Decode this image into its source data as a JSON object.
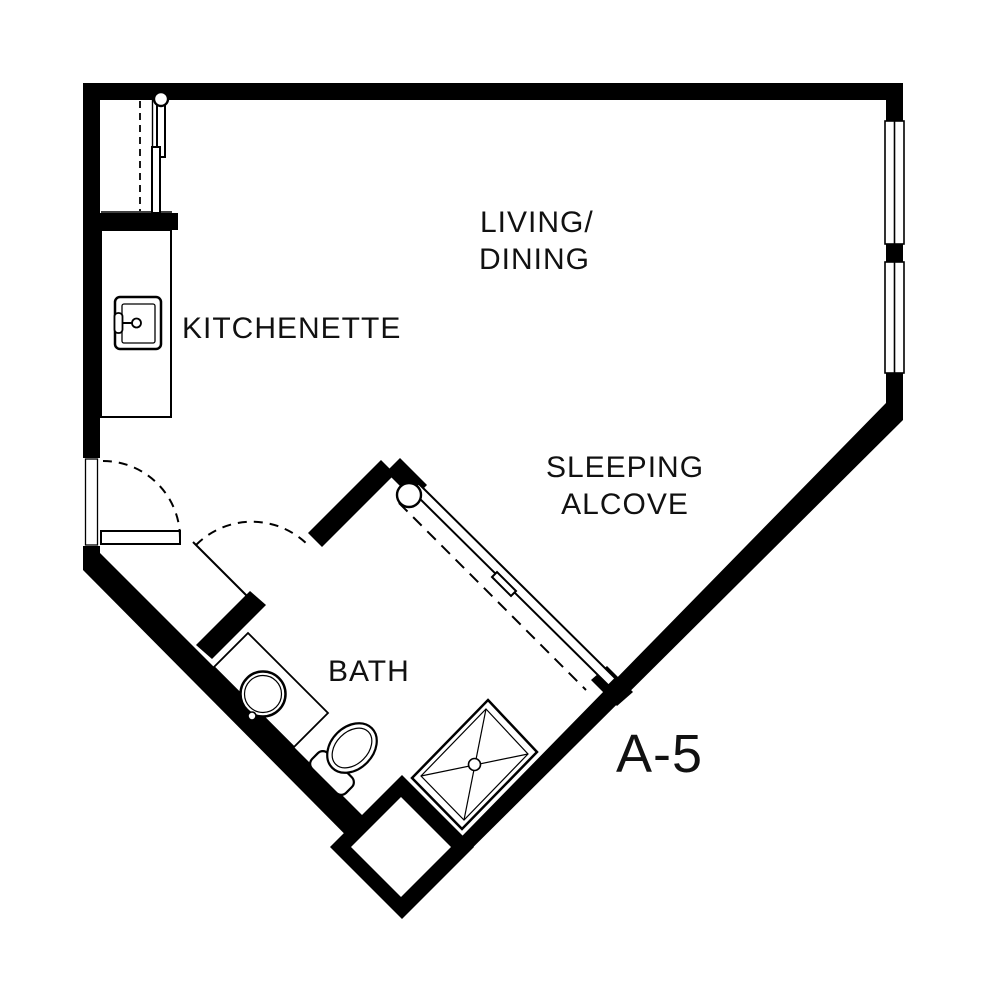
{
  "unit": {
    "label": "A-5"
  },
  "rooms": {
    "living_dining": {
      "line1": "LIVING/",
      "line2": "DINING"
    },
    "kitchenette": {
      "label": "KITCHENETTE"
    },
    "sleeping_alcove": {
      "line1": "SLEEPING",
      "line2": "ALCOVE"
    },
    "bath": {
      "label": "BATH"
    }
  },
  "fixtures": {
    "kitchen_sink": "kitchen-sink",
    "bath_sink": "round-lavatory-sink",
    "toilet": "toilet",
    "shower": "corner-shower",
    "utility_closet": "utility-closet",
    "entry_door": "entry-swing-door",
    "bath_door": "bath-swing-door",
    "sliding_door": "sliding-door",
    "window_upper": "window",
    "window_lower": "window",
    "niche": "chase-niche"
  },
  "colors": {
    "wall": "#000000",
    "floor": "#ffffff",
    "text": "#111111"
  }
}
